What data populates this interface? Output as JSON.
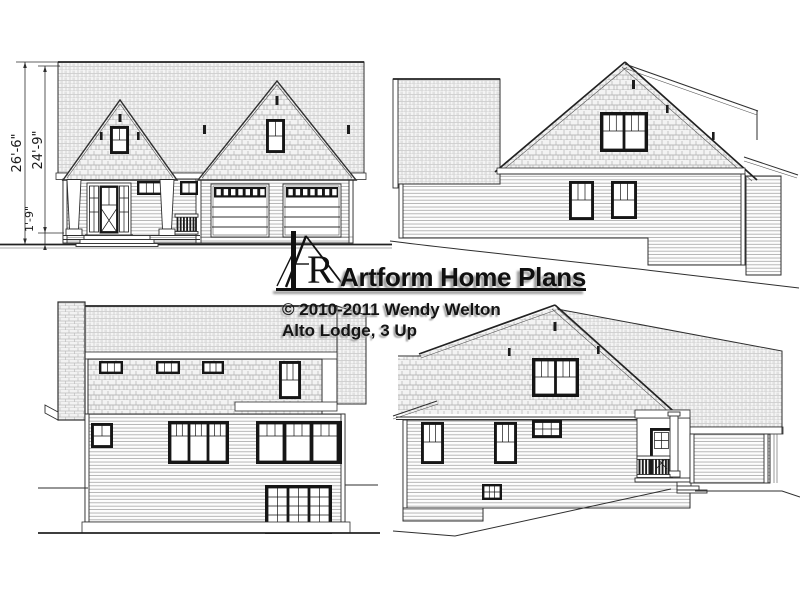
{
  "sheet": {
    "background": "#ffffff"
  },
  "watermark": {
    "brand": "Artform Home Plans",
    "copyright": "© 2010-2011 Wendy Welton",
    "plan_name": "Alto Lodge, 3 Up",
    "logo_letter": "R"
  },
  "dimension_labels": {
    "overall_height": "26'-6\"",
    "roof_height": "24'-9\"",
    "floor_height": "1'-9\""
  },
  "colors": {
    "line": "#2e2e2e",
    "roof_fill": "#f4f4f4",
    "shingle_fill": "#f3f3f3",
    "siding_fill": "#fdfdfd",
    "brick_fill": "#f2f2f2",
    "window_frame": "#161616",
    "watermark_text": "#101010",
    "watermark_shadow": "#9b9b9b"
  }
}
